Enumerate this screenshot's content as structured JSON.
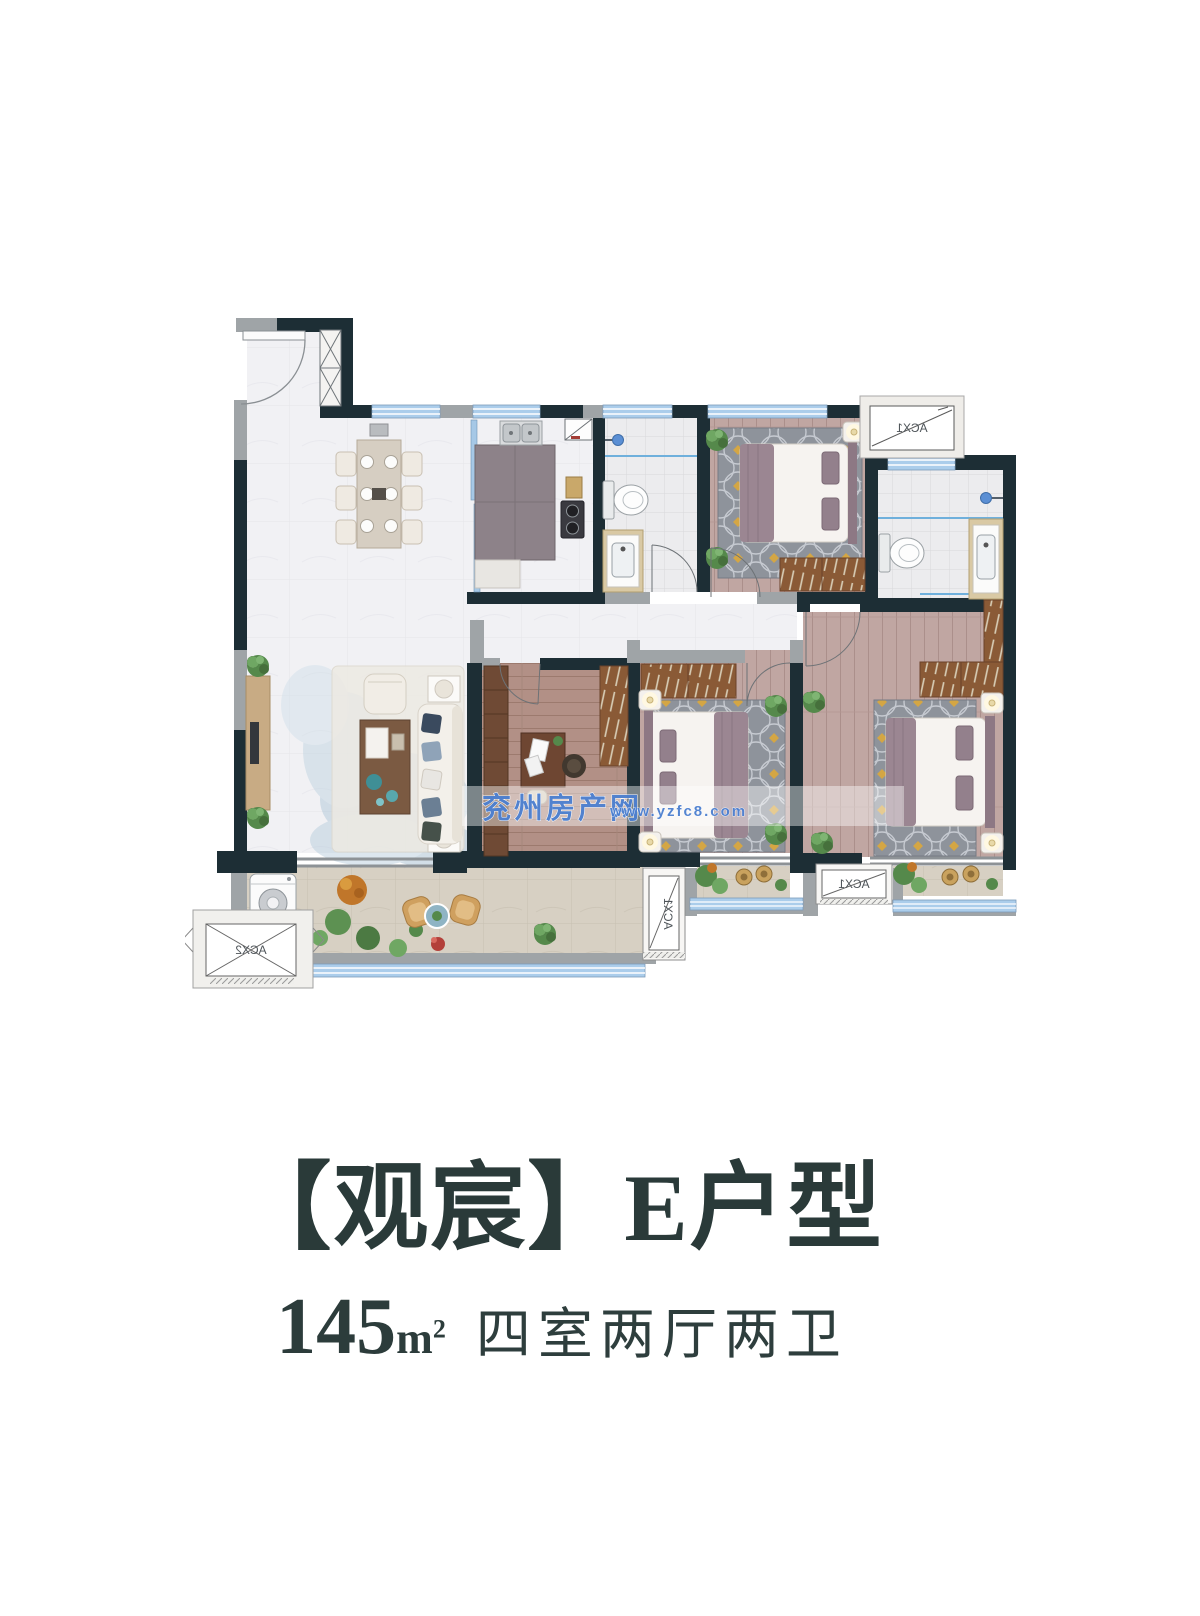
{
  "caption": {
    "title": "【观宸】E户型",
    "area_value": "145",
    "area_unit_base": "m",
    "area_unit_exponent": "2",
    "layout_text": "四室两厅两卫",
    "text_color": "#2a3a39"
  },
  "floor_plan": {
    "watermark": {
      "site_name": "兖州房产网",
      "site_url": "www.yzfc8.com",
      "color": "#4c7fd0"
    },
    "ac_labels": {
      "top_right": "ACX1",
      "mid_bottom": "ACX1",
      "bottom_right": "ACX1",
      "bottom_left": "ACX2"
    },
    "colors": {
      "wall": "#1d2e35",
      "wall_secondary": "#9fa4a7",
      "window": "#abcdeb",
      "bedroom_floor": "#c0a6a2",
      "living_floor": "#f1f1f4",
      "balcony_floor": "#d7d0c3",
      "accent_gold": "#d4a644"
    }
  }
}
